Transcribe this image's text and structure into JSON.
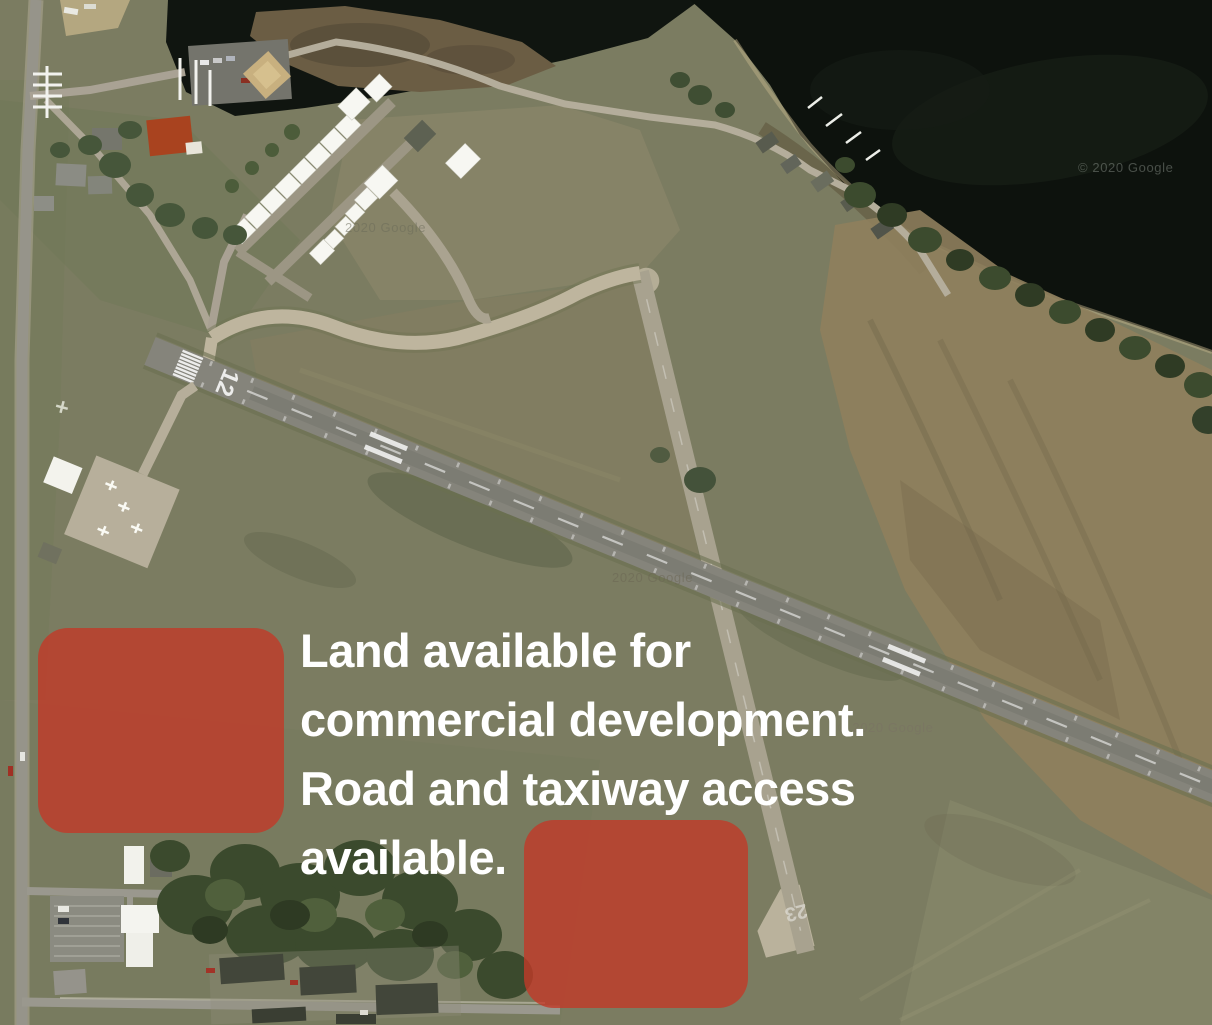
{
  "annotation": {
    "lines": [
      "Land available for",
      "commercial development.",
      "Road and taxiway access",
      "available."
    ],
    "color": "#ffffff"
  },
  "overlays": {
    "color": "#c23a28",
    "opacity": "0.8",
    "parcel_count": 2
  },
  "runway": {
    "number_12": "12",
    "number_23": "23"
  },
  "watermarks": {
    "wm1": "2020 Google",
    "wm2": "2020 Google",
    "wm3": "© 2020 Google",
    "wm4": "© 2020 Google"
  }
}
